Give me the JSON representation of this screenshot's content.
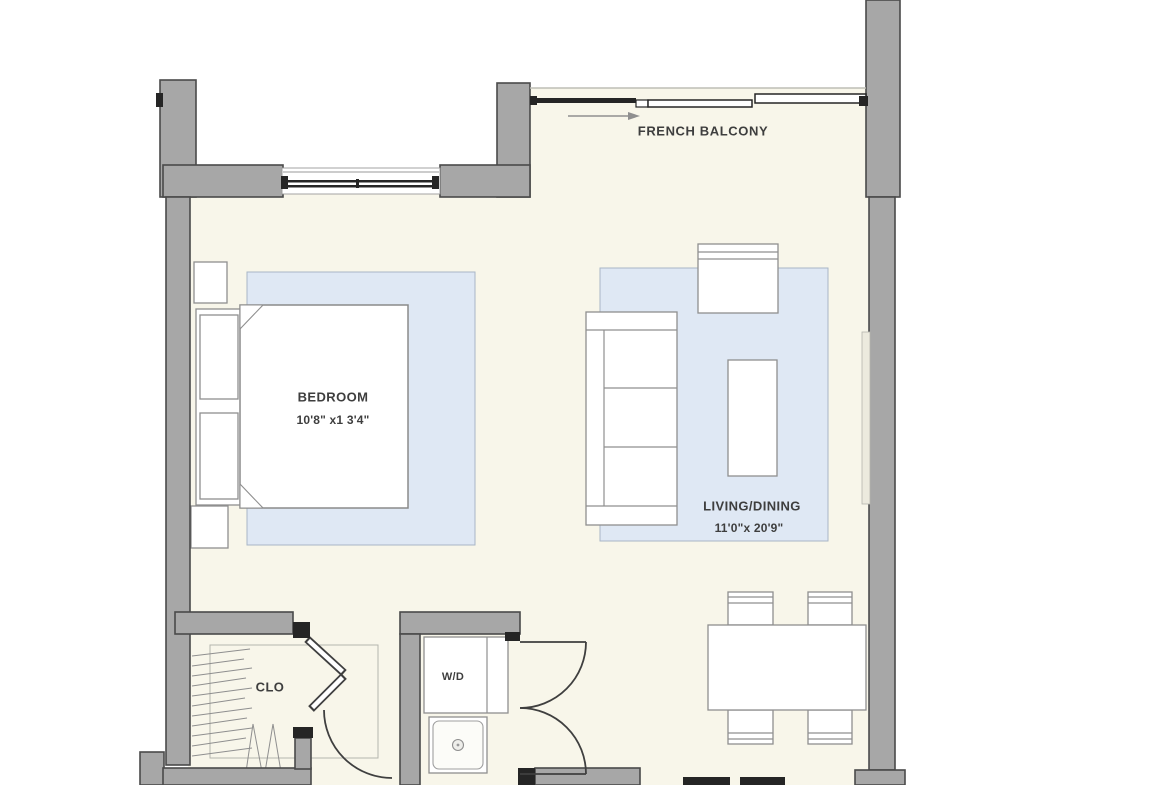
{
  "plan": {
    "balcony_label": "FRENCH BALCONY",
    "bedroom_label": "BEDROOM",
    "bedroom_dims": "10'8\" x1 3'4\"",
    "living_label": "LIVING/DINING",
    "living_dims": "11'0\"x 20'9\"",
    "closet_label": "CLO",
    "laundry_label": "W/D"
  },
  "colors": {
    "background": "#ffffff",
    "floor": "#f8f6ea",
    "rug": "#dfe8f4",
    "rug_border": "#a9b5c6",
    "wall_fill": "#a7a7a7",
    "wall_stroke": "#4a4a4a",
    "dark_detail": "#252525",
    "furniture_line": "#8f8f8f",
    "text": "#3e3e3e"
  }
}
